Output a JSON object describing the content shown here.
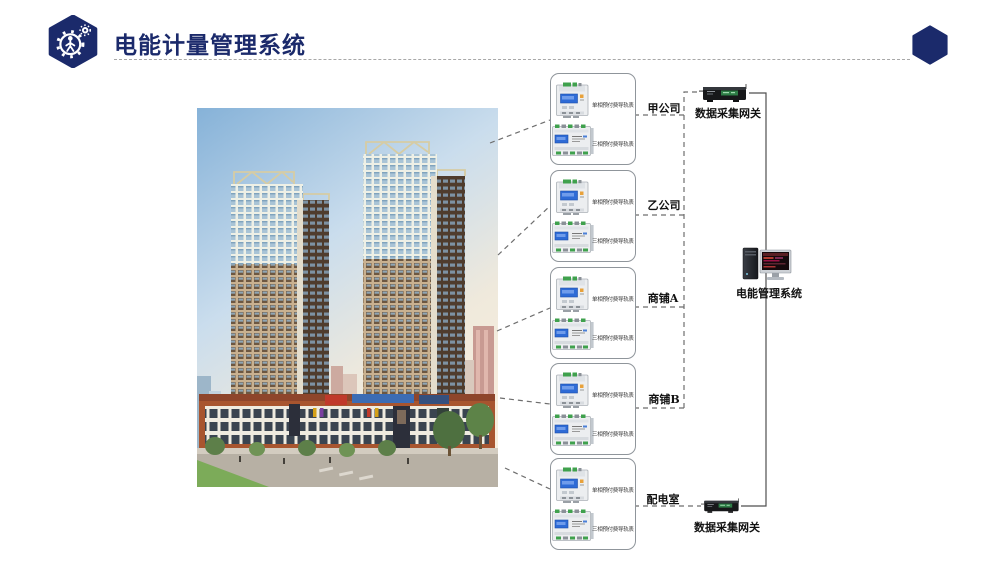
{
  "header": {
    "title": "电能计量管理系统"
  },
  "diagram": {
    "groups": [
      {
        "label": "甲公司",
        "meter_top": "单相预付费导轨表",
        "meter_bottom": "三相预付费导轨表"
      },
      {
        "label": "乙公司",
        "meter_top": "单相预付费导轨表",
        "meter_bottom": "三相预付费导轨表"
      },
      {
        "label": "商铺A",
        "meter_top": "单相预付费导轨表",
        "meter_bottom": "三相预付费导轨表"
      },
      {
        "label": "商铺B",
        "meter_top": "单相预付费导轨表",
        "meter_bottom": "三相预付费导轨表"
      },
      {
        "label": "配电室",
        "meter_top": "单相预付费导轨表",
        "meter_bottom": "三相预付费导轨表"
      }
    ],
    "gateway_top_label": "数据采集网关",
    "gateway_bottom_label": "数据采集网关",
    "server_label": "电能管理系统"
  },
  "icons": {
    "logo": "gear-person-hexagon",
    "decor": "hexagon",
    "meter_single": "single-phase-din-rail-meter",
    "meter_three": "three-phase-din-rail-meter",
    "gateway": "data-acquisition-gateway-device",
    "server": "desktop-computer"
  },
  "colors": {
    "navy": "#1b2a6b",
    "wire": "#4f4f4f",
    "dash": "#6e6e6e",
    "box_border": "#8f959b",
    "meter_screen": "#2e6bd6",
    "gateway_green": "#2e7d46"
  }
}
